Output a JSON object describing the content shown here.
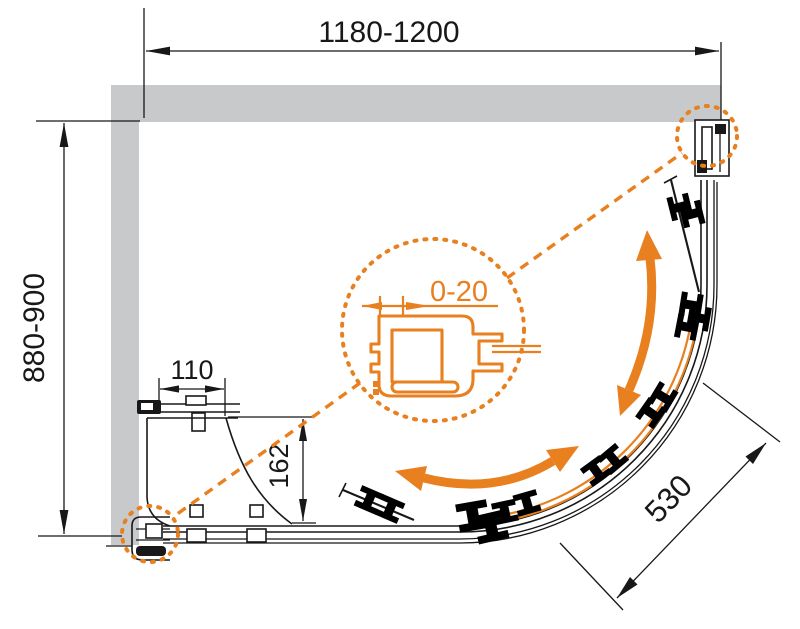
{
  "drawing_title": "Quarter-round shower enclosure plan view with installation dimensions",
  "dimensions": {
    "overall_width": "1180-1200",
    "overall_depth": "880-900",
    "side_panel_width": "110",
    "side_panel_return": "162",
    "door_radius": "530",
    "wall_profile_adjustment": "0-20"
  },
  "colors": {
    "accent": "#E8801F",
    "wall": "#C7C9CB",
    "line": "#181818",
    "bg": "#FFFFFF"
  }
}
